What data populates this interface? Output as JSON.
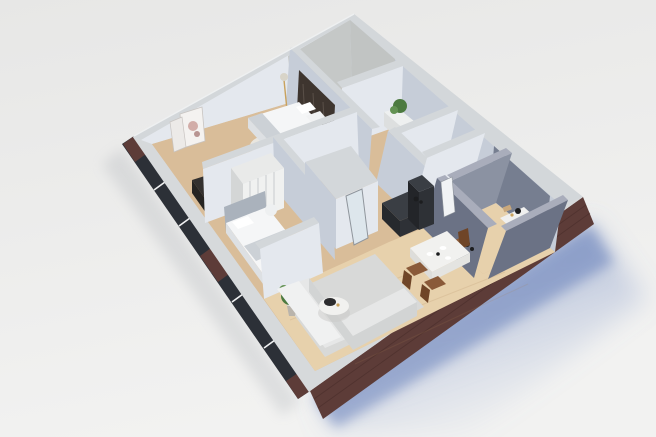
{
  "scene": {
    "type": "3d-isometric-floorplan-render",
    "rooms": [
      "bedroom-1",
      "bedroom-2",
      "living-room",
      "dining-area",
      "kitchen",
      "corridor",
      "bathroom",
      "wc",
      "utility-room",
      "closet"
    ],
    "furniture": [
      "double-bed",
      "single-bed",
      "wardrobe",
      "leaning-art-frames",
      "desk",
      "floor-lamp",
      "sofa",
      "coffee-table",
      "potted-plant",
      "dining-table",
      "dining-chairs",
      "kitchen-counter",
      "leaning-mirror",
      "vanity-mat",
      "towels"
    ]
  },
  "colors": {
    "bg1": "#e7e7e6",
    "bg2": "#f2f2f1",
    "shadowBlue": "#5e79b7",
    "shadowBlueSoft": "#8ba0cf",
    "shadowGray": "#a9adb3",
    "brick": "#5d3c38",
    "brickDark": "#462b28",
    "slab": "#d6d9db",
    "wallTop": "#d3d7da",
    "wallLight": "#e4e8ee",
    "wallMid": "#c6cdd8",
    "concrete": "#bfc2c0",
    "concreteFloor": "#c8c8c5",
    "darkWall": "#6b7285",
    "darkWallLight": "#8b92a2",
    "darkWallTop": "#a9adbb",
    "woodBase": "#d9bd99",
    "woodLight": "#e7d1ac",
    "plank": "#a87f55",
    "rug": "#d8d9d8",
    "rugRound": "#eae8e3",
    "bedding": "#f5f6f7",
    "beddingShade": "#dde0e3",
    "blanket": "#ccd1d6",
    "headboardDark": "#3e352f",
    "furnDark": "#33302e",
    "kitchenDark": "#2e3136",
    "grayHeadboard": "#aab2bc",
    "wardrobe": "#e9eae9",
    "louver": "#c9ccce",
    "sofa": "#e6e7e7",
    "sofaShade": "#d2d4d4",
    "tableWhite": "#f1f1ef",
    "chairBrown": "#8a5a39",
    "chairBrownDark": "#6f4527",
    "plantGreen": "#4c7a40",
    "plantGreenLight": "#639253",
    "glass": "#2c3037",
    "mullion": "#f0f1f2",
    "gold": "#c9a25e",
    "towel": "#c9a87c",
    "black": "#1c1d1f",
    "mirror": "#dde6ec",
    "mirrorFrame": "#8f959c",
    "door": "#f1f3f5",
    "artPink": "#c99b96"
  }
}
